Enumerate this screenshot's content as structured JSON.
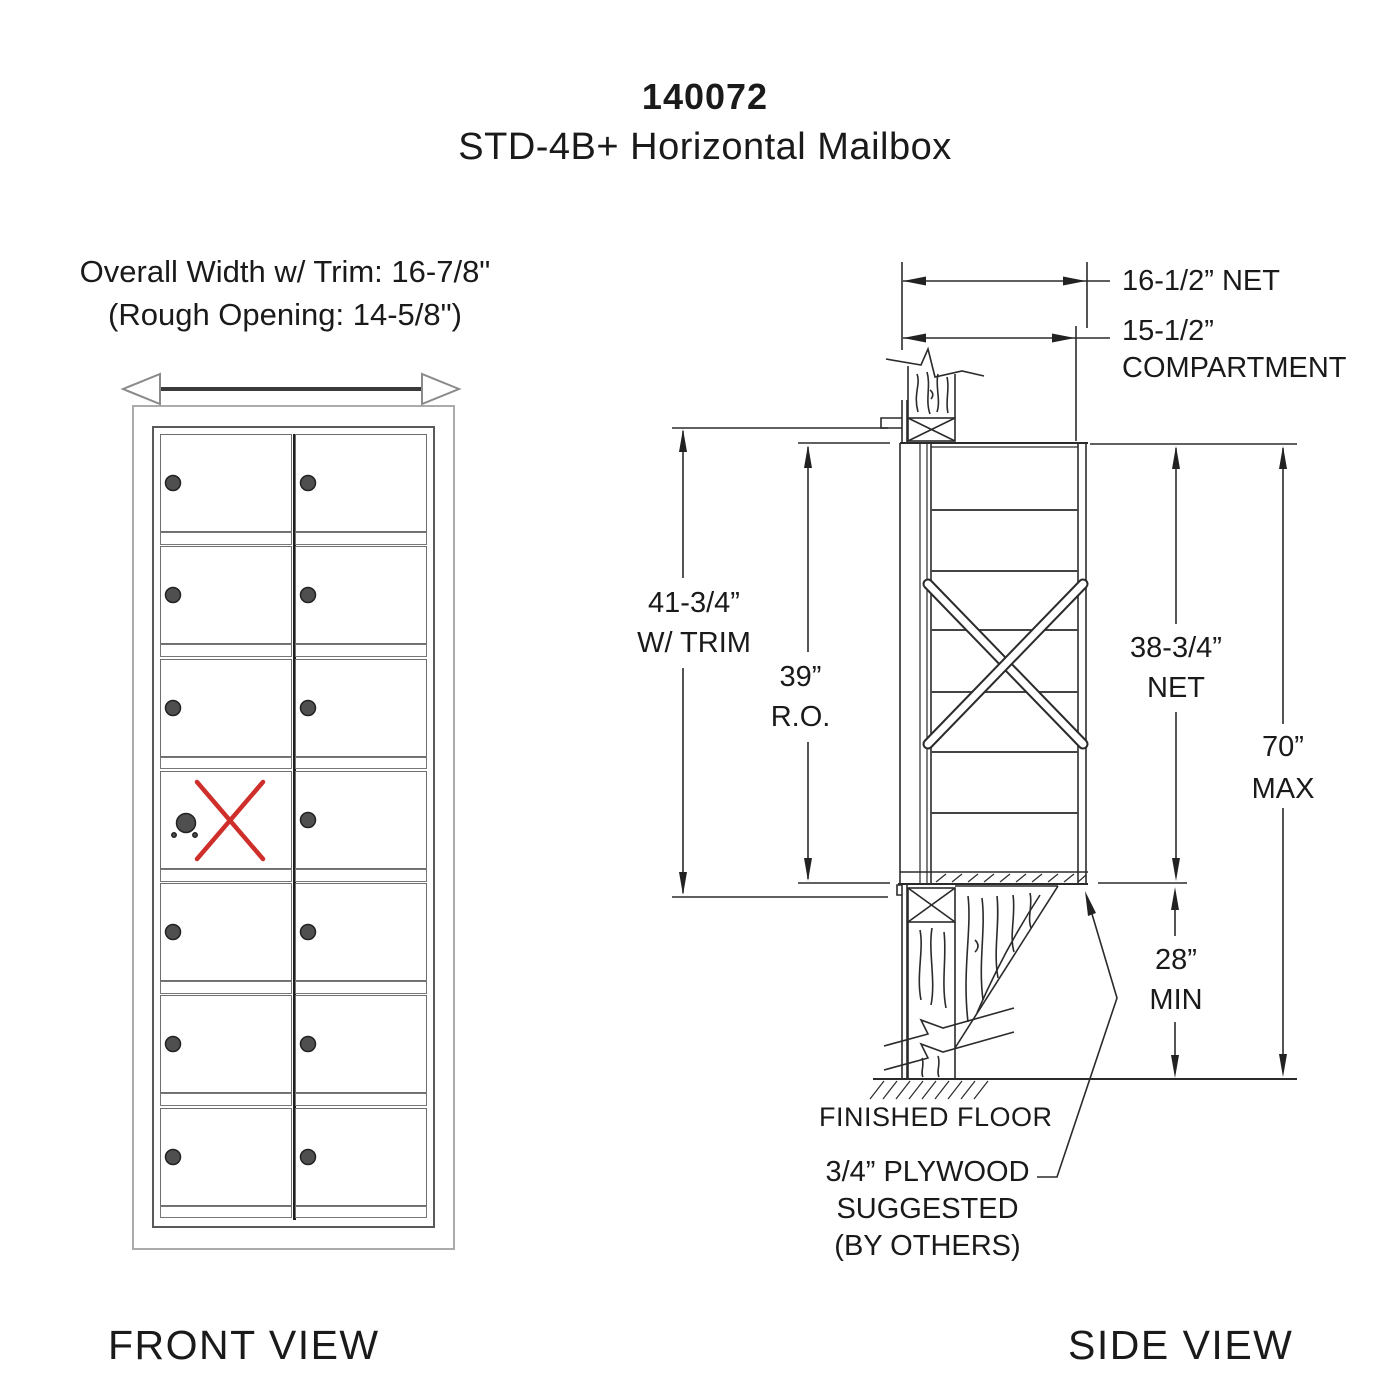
{
  "title": {
    "model": "140072",
    "product": "STD-4B+ Horizontal Mailbox"
  },
  "front_view": {
    "view_label": "FRONT VIEW",
    "overall_width_note": "Overall Width w/ Trim: 16-7/8\"",
    "rough_opening_note": "(Rough Opening: 14-5/8\")",
    "grid": {
      "rows": 7,
      "columns": 2,
      "master_door_row": 4,
      "master_door_col": 1
    },
    "colors": {
      "rejected_x": "#cf2f2b",
      "lock_fill": "#4f4f4f"
    }
  },
  "side_view": {
    "view_label": "SIDE VIEW",
    "dim_net_width": "16-1/2” NET",
    "dim_compartment_width_1": "15-1/2”",
    "dim_compartment_width_2": "COMPARTMENT",
    "dim_trim_height_1": "41-3/4”",
    "dim_trim_height_2": "W/ TRIM",
    "dim_ro_height_1": "39”",
    "dim_ro_height_2": "R.O.",
    "dim_net_height_1": "38-3/4”",
    "dim_net_height_2": "NET",
    "dim_max_height_1": "70”",
    "dim_max_height_2": "MAX",
    "dim_min_height_1": "28”",
    "dim_min_height_2": "MIN",
    "note_finished_floor": "FINISHED FLOOR",
    "note_plywood_1": "3/4” PLYWOOD",
    "note_plywood_2": "SUGGESTED",
    "note_plywood_3": "(BY OTHERS)"
  }
}
